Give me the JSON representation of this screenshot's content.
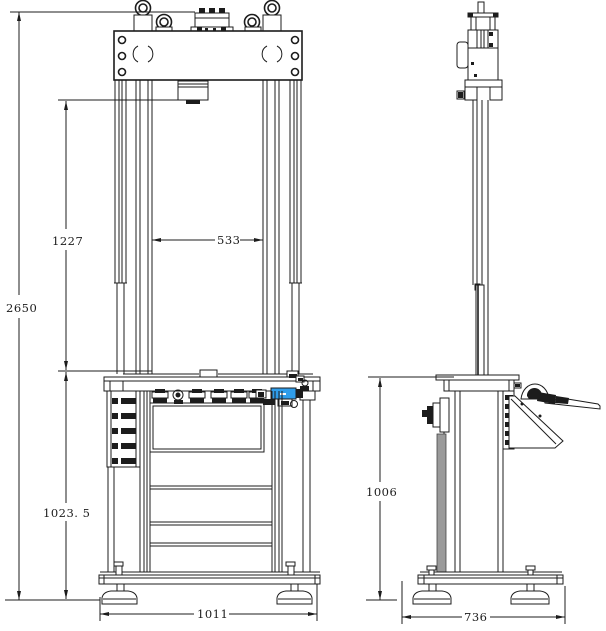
{
  "drawing": {
    "type": "technical-2-view-cad-drawing",
    "subject": "column type testing machine / press, front and side orthographic views",
    "background": "#ffffff",
    "line_color": "#1c1c1c",
    "accent_blue": "#2f9dea",
    "panel_gray": "#9a9a9a"
  },
  "dimensions": {
    "front": {
      "overall_height": "2650",
      "clearance_height": "1227",
      "column_clear_width": "533",
      "bench_height": "1023. 5",
      "base_width": "1011"
    },
    "side": {
      "bench_height": "1006",
      "base_depth": "736"
    }
  }
}
